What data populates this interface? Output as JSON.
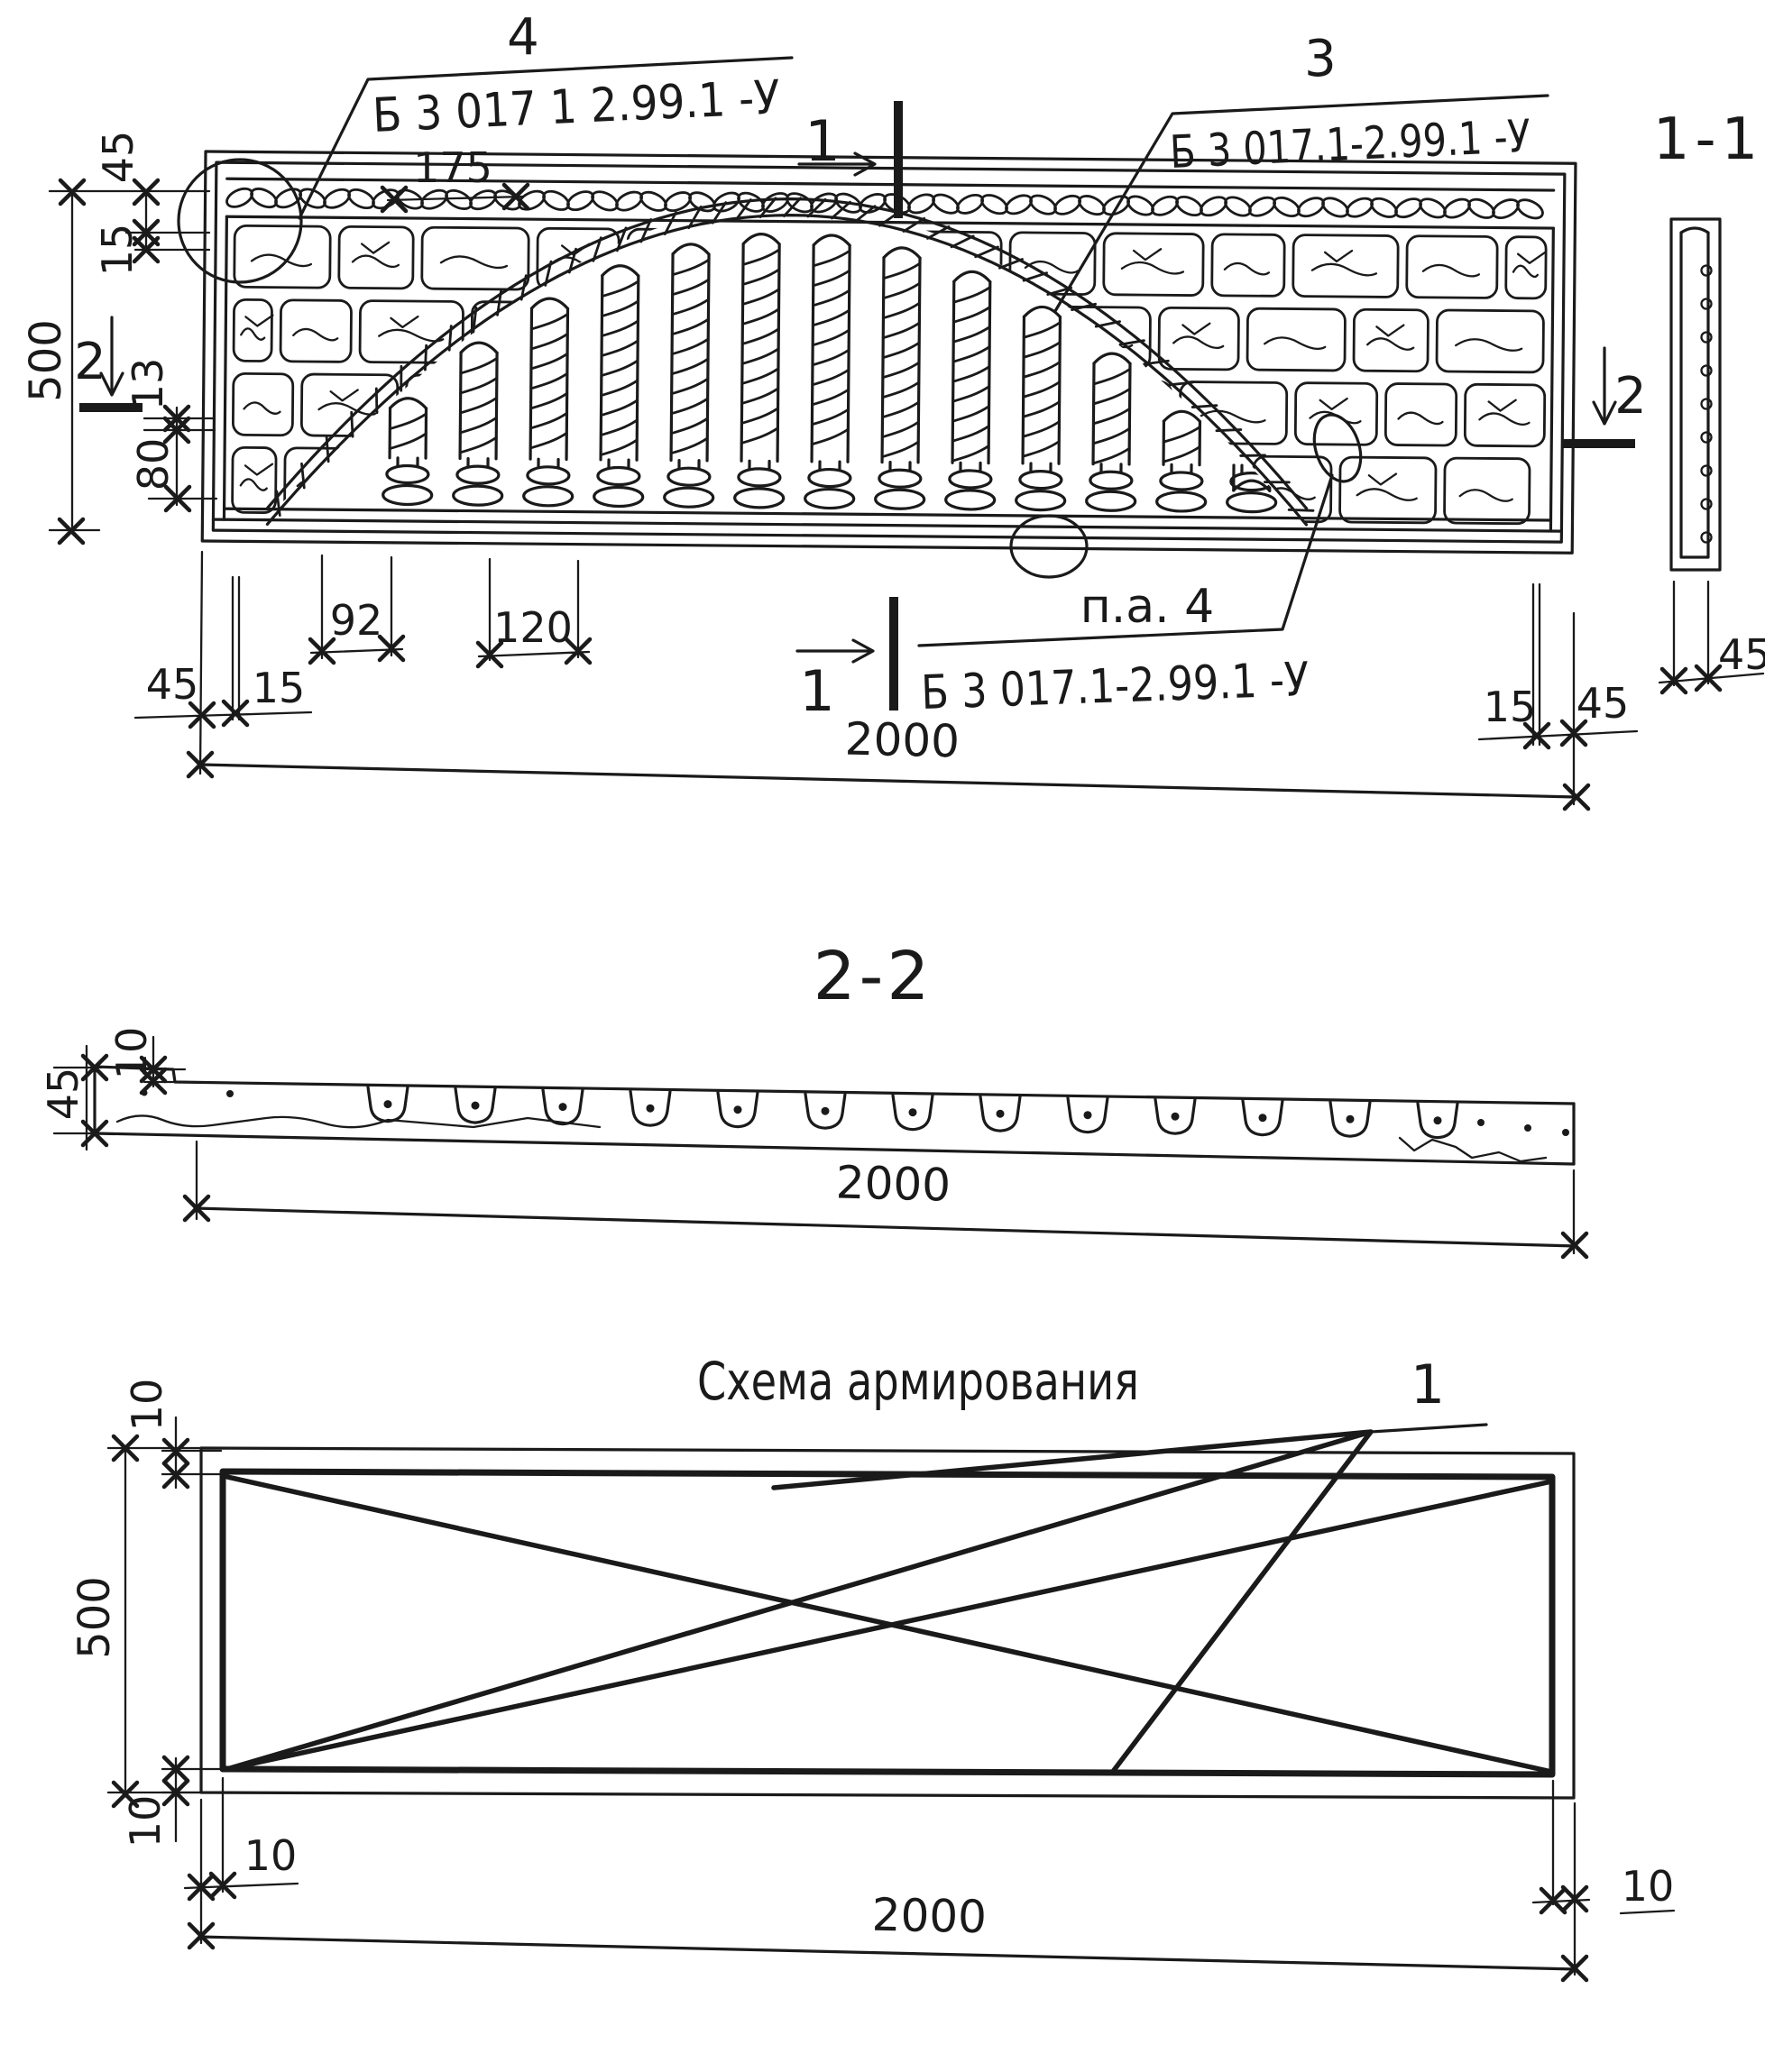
{
  "colors": {
    "ink": "#1a1a1a",
    "paper": "#ffffff"
  },
  "elevation": {
    "callout_4": {
      "ref": "4",
      "code": "Б 3 017 1 2.99.1 -У"
    },
    "callout_3": {
      "ref": "3",
      "code": "Б 3 017.1-2.99.1 -У"
    },
    "callout_pa4": {
      "ref": "п.а. 4",
      "code": "Б 3 017.1-2.99.1 -У"
    },
    "section_cut_1": "1",
    "section_cut_2": "2",
    "section_view_label": "1-1",
    "dims": {
      "d45": "45",
      "d15": "15",
      "d500": "500",
      "d13": "13",
      "d80": "80",
      "d175": "175",
      "d92": "92",
      "d120": "120",
      "d2000": "2000"
    }
  },
  "section_2_2": {
    "title": "2-2",
    "dims": {
      "d45": "45",
      "d10": "10",
      "d2000": "2000"
    }
  },
  "reinforcement": {
    "title": "Схема армирования",
    "bar_ref": "1",
    "dims": {
      "d10": "10",
      "d500": "500",
      "d2000": "2000"
    }
  }
}
